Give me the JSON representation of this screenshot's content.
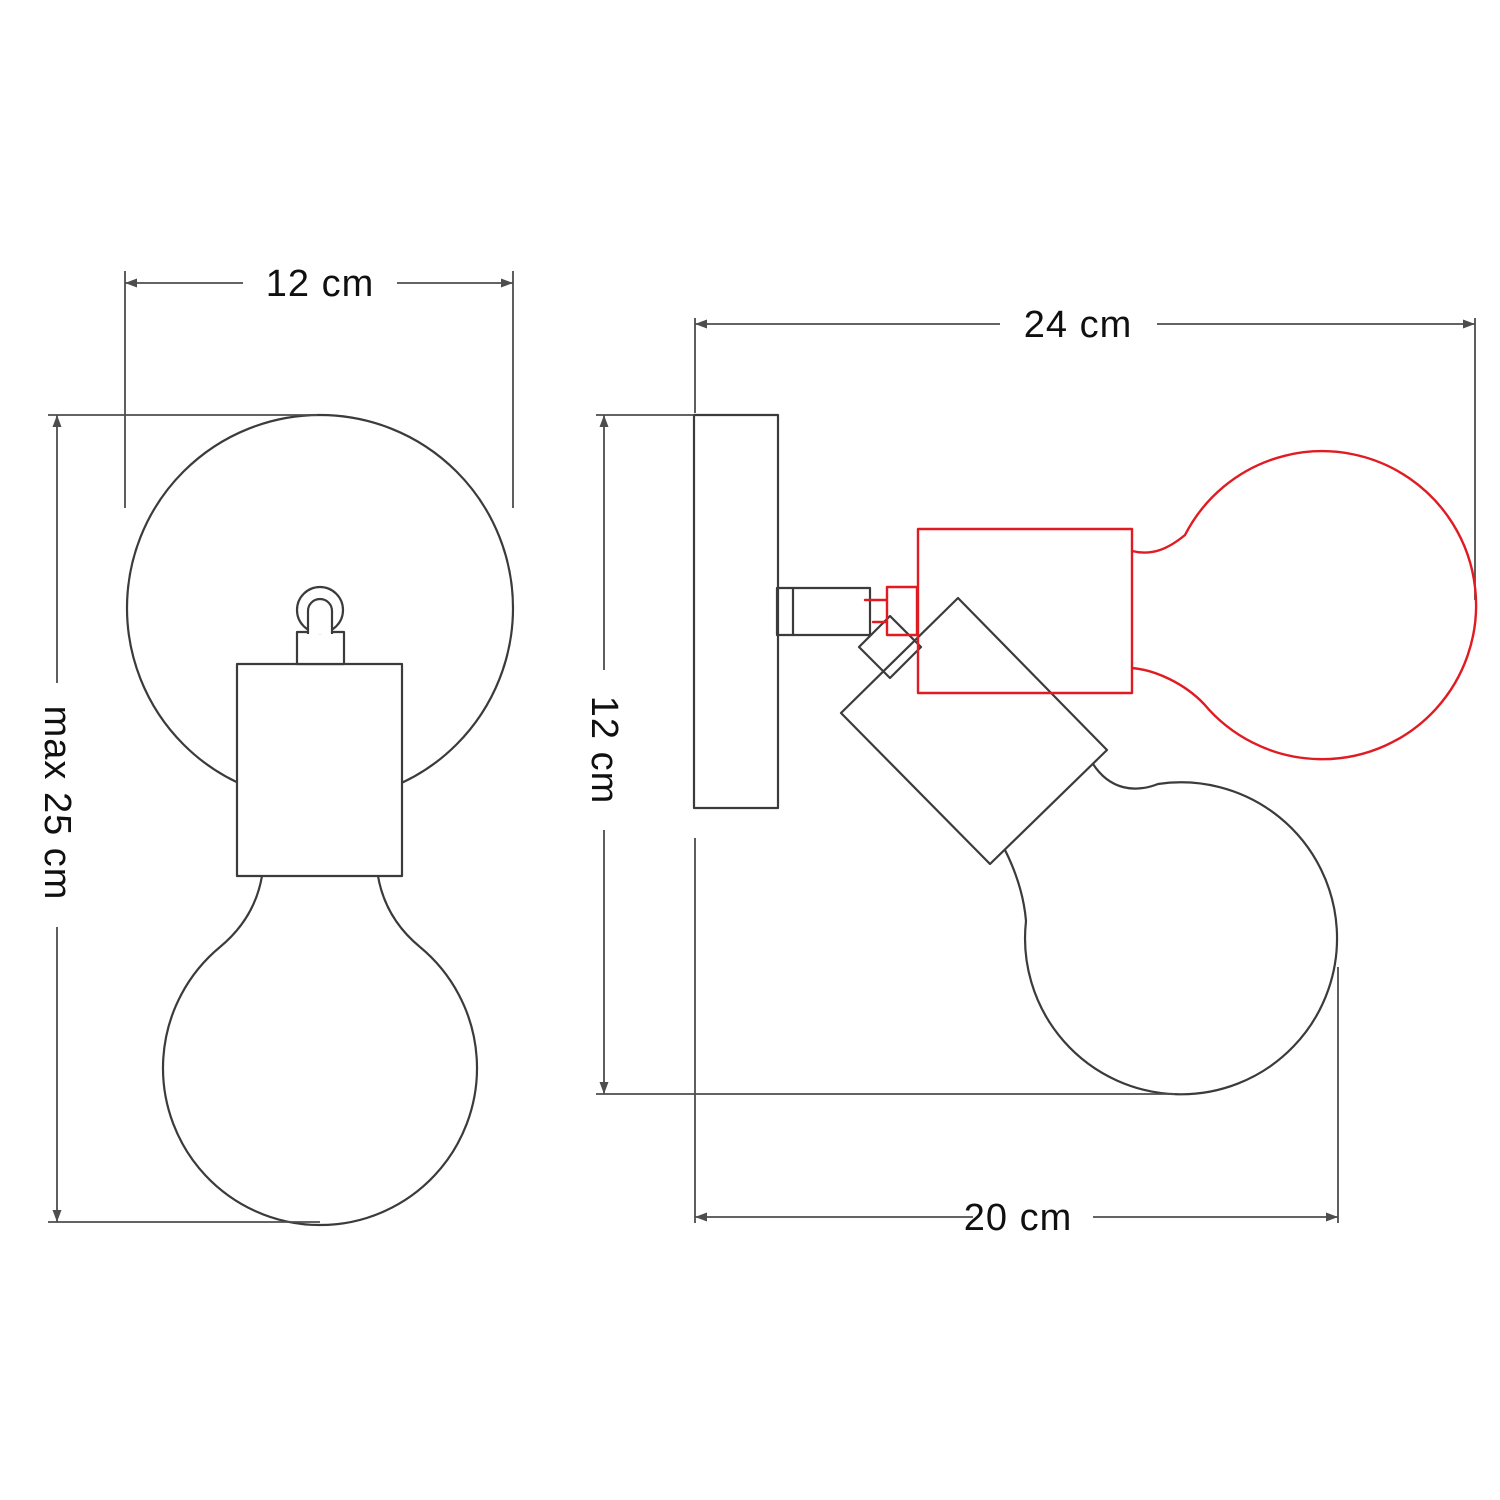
{
  "diagram": {
    "title": "Adjustable wall lamp — technical dimension drawing (front and side views)",
    "colors": {
      "object_line": "#3b3b3b",
      "dimension_line": "#4d4d4d",
      "alternate_position_red": "#e11b22",
      "text": "#101010",
      "background": "#ffffff"
    },
    "front_view": {
      "name": "front view",
      "width_label": "12 cm",
      "height_label": "max 25 cm"
    },
    "side_view": {
      "name": "side view",
      "depth_label": "24 cm",
      "plate_height_label": "12 cm",
      "projection_label": "20 cm"
    }
  }
}
